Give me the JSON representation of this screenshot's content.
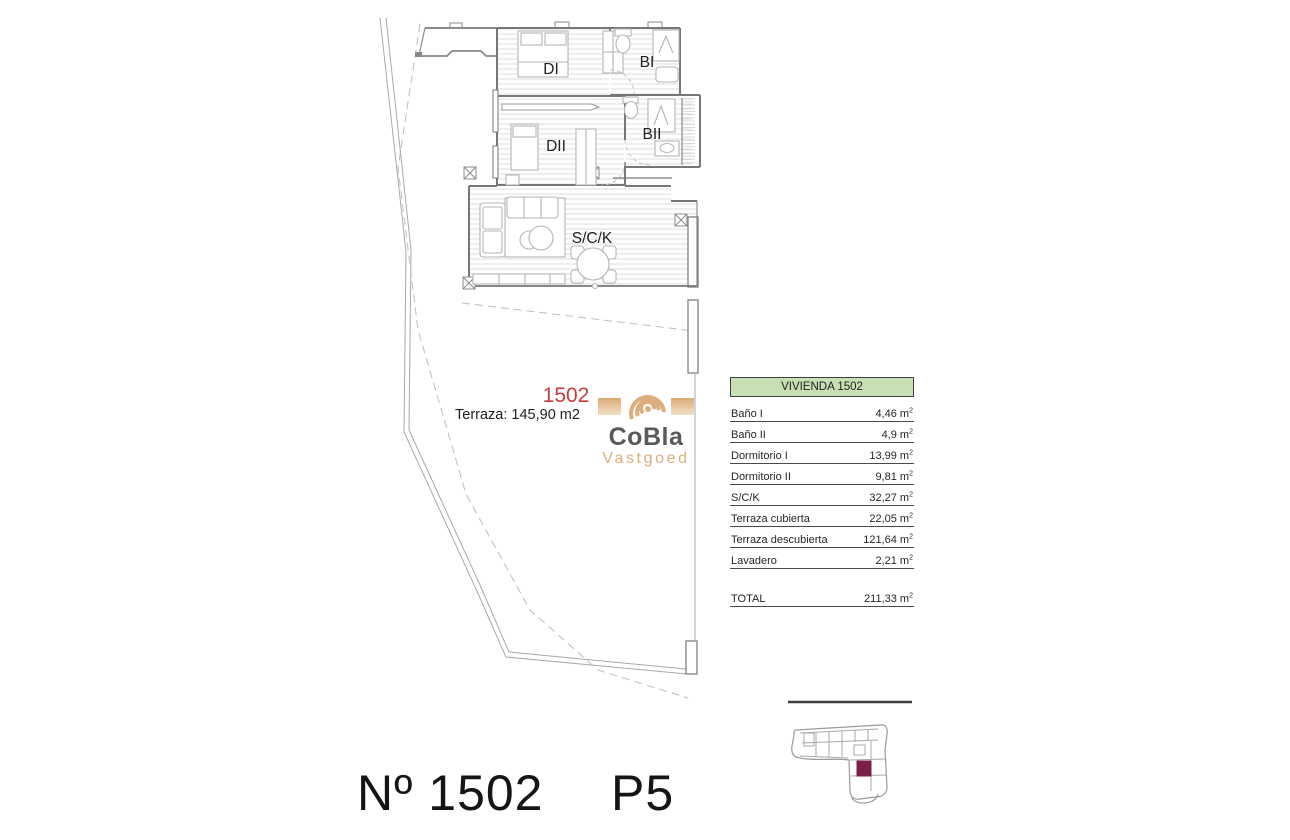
{
  "page": {
    "background": "#ffffff"
  },
  "plan": {
    "unit_number": "1502",
    "unit_number_color": "#c63d3e",
    "terrace_label": "Terraza: 145,90 m2",
    "rooms": {
      "dormitorio1": "DI",
      "bano1": "BI",
      "dormitorio2": "DII",
      "bano2": "BII",
      "salon": "S/C/K"
    }
  },
  "logo": {
    "name": "CoBla",
    "subtitle": "Vastgoed",
    "name_color": "#58595b",
    "accent_color": "#dcae7d"
  },
  "table": {
    "title": "VIVIENDA 1502",
    "header_bg": "#c6e0b4",
    "unit_base": "m",
    "unit_exp": "2",
    "rows": [
      {
        "label": "Baño I",
        "value": "4,46"
      },
      {
        "label": "Baño II",
        "value": "4,9"
      },
      {
        "label": "Dormitorio I",
        "value": "13,99"
      },
      {
        "label": "Dormitorio II",
        "value": "9,81"
      },
      {
        "label": "S/C/K",
        "value": "32,27"
      },
      {
        "label": "Terraza cubierta",
        "value": "22,05"
      },
      {
        "label": "Terraza descubierta",
        "value": "121,64"
      },
      {
        "label": "Lavadero",
        "value": "2,21"
      }
    ],
    "total": {
      "label": "TOTAL",
      "value": "211,33"
    }
  },
  "keyplan": {
    "highlight_color": "#7a2044"
  },
  "footer": {
    "unit_label": "Nº 1502",
    "floor_label": "P5"
  }
}
